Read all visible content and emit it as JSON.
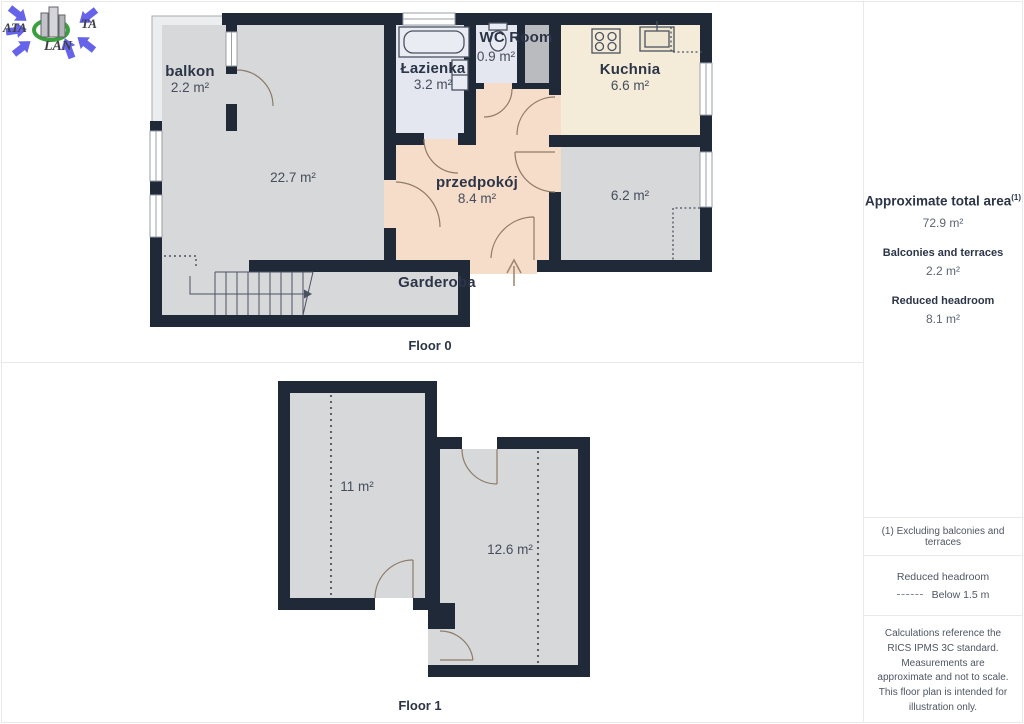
{
  "logo": {
    "ata": "ATA",
    "ta": "TA",
    "lan": "LAN"
  },
  "floor0": {
    "title": "Floor 0",
    "rooms": {
      "balkon": {
        "name": "balkon",
        "area": "2.2 m²"
      },
      "living": {
        "name": "",
        "area": "22.7 m²"
      },
      "lazienka": {
        "name": "Łazienka",
        "area": "3.2 m²"
      },
      "wc": {
        "name": "WC Room",
        "area": "0.9 m²"
      },
      "kuchnia": {
        "name": "Kuchnia",
        "area": "6.6 m²"
      },
      "przedpokoj": {
        "name": "przedpokój",
        "area": "8.4 m²"
      },
      "room62": {
        "name": "",
        "area": "6.2 m²"
      },
      "garderoba": {
        "name": "Garderoba",
        "area": ""
      }
    }
  },
  "floor1": {
    "title": "Floor 1",
    "rooms": {
      "room11": {
        "area": "11 m²"
      },
      "room126": {
        "area": "12.6 m²"
      }
    }
  },
  "sidebar": {
    "total_label": "Approximate total area",
    "total_sup": "(1)",
    "total_value": "72.9 m²",
    "balconies_label": "Balconies and terraces",
    "balconies_value": "2.2 m²",
    "reduced_label": "Reduced headroom",
    "reduced_value": "8.1 m²",
    "note": "(1) Excluding balconies and terraces",
    "legend_title": "Reduced headroom",
    "legend_value": "Below 1.5 m",
    "disclaimer": "Calculations reference the RICS IPMS 3C standard. Measurements are approximate and not to scale. This floor plan is intended for illustration only.",
    "brand_left": "GIRAFFE",
    "brand_right": "360"
  },
  "colors": {
    "wall": "#1f2938",
    "room_gray": "#d7d8da",
    "balcony": "#ecedee",
    "bath_blue": "#e4e7f0",
    "kitchen_cream": "#f4ecd8",
    "hall_peach": "#f6ddc9",
    "shaft_gray": "#b9bbbe",
    "logo_blue": "#5b58ea",
    "logo_green": "#3aa03c",
    "door_arc": "#8d7b69"
  }
}
